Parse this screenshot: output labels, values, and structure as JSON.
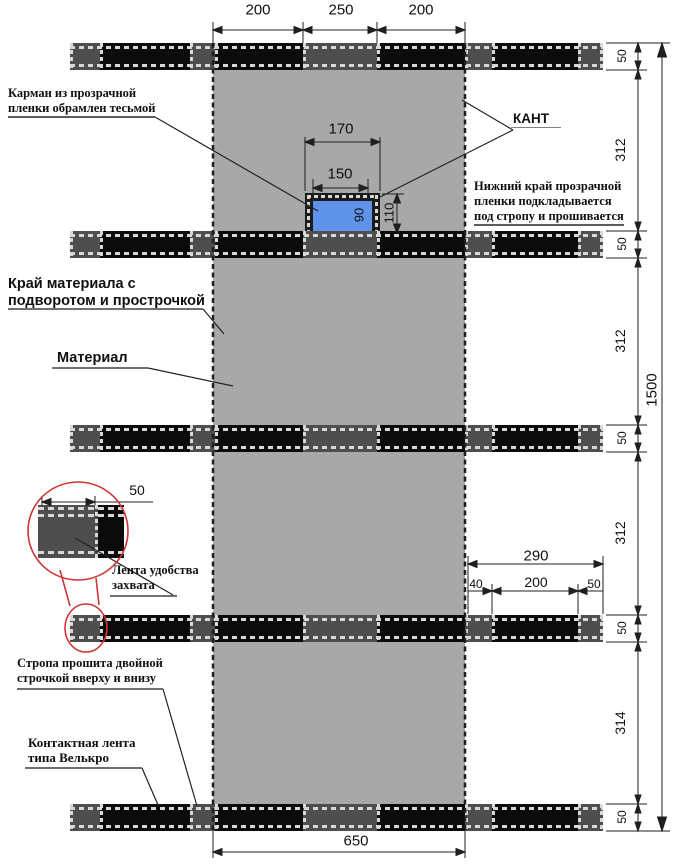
{
  "drawing": {
    "labels": {
      "pocket_l1": "Карман из прозрачной",
      "pocket_l2": "пленки обрамлен тесьмой",
      "kant": "КАНТ",
      "film_l1": "Нижний край прозрачной",
      "film_l2": "пленки подкладывается",
      "film_l3": "под стропу и прошивается",
      "mat_edge_l1": "Край материала с",
      "mat_edge_l2": "подворотом и прострочкой",
      "material": "Материал",
      "grip_l1": "Лента удобства",
      "grip_l2": "захвата",
      "strap_l1": "Стропа прошита двойной",
      "strap_l2": "строчкой вверху и внизу",
      "velcro_l1": "Контактная лента",
      "velcro_l2": "типа Велькро"
    },
    "dims": {
      "top": [
        "200",
        "250",
        "200"
      ],
      "bottom_width": "650",
      "pocket_outer_w": "170",
      "pocket_inner_w": "150",
      "pocket_outer_h": "110",
      "pocket_inner_h": "90",
      "strap_height": "50",
      "gaps": [
        "312",
        "312",
        "312",
        "314"
      ],
      "total_height": "1500",
      "offset_total": "290",
      "offset_left": "40",
      "offset_mid": "200",
      "offset_right": "50",
      "grip_width": "50"
    },
    "colors": {
      "material": "#a8a8a8",
      "strap": "#4e4e4e",
      "velcro": "#0b0b0b",
      "stitch": "#d8d8d8",
      "pocket_film": "#5f93ea",
      "pocket_tape": "#1b1b1b",
      "detail_ring": "#d03535",
      "line": "#1f1f1f"
    }
  }
}
